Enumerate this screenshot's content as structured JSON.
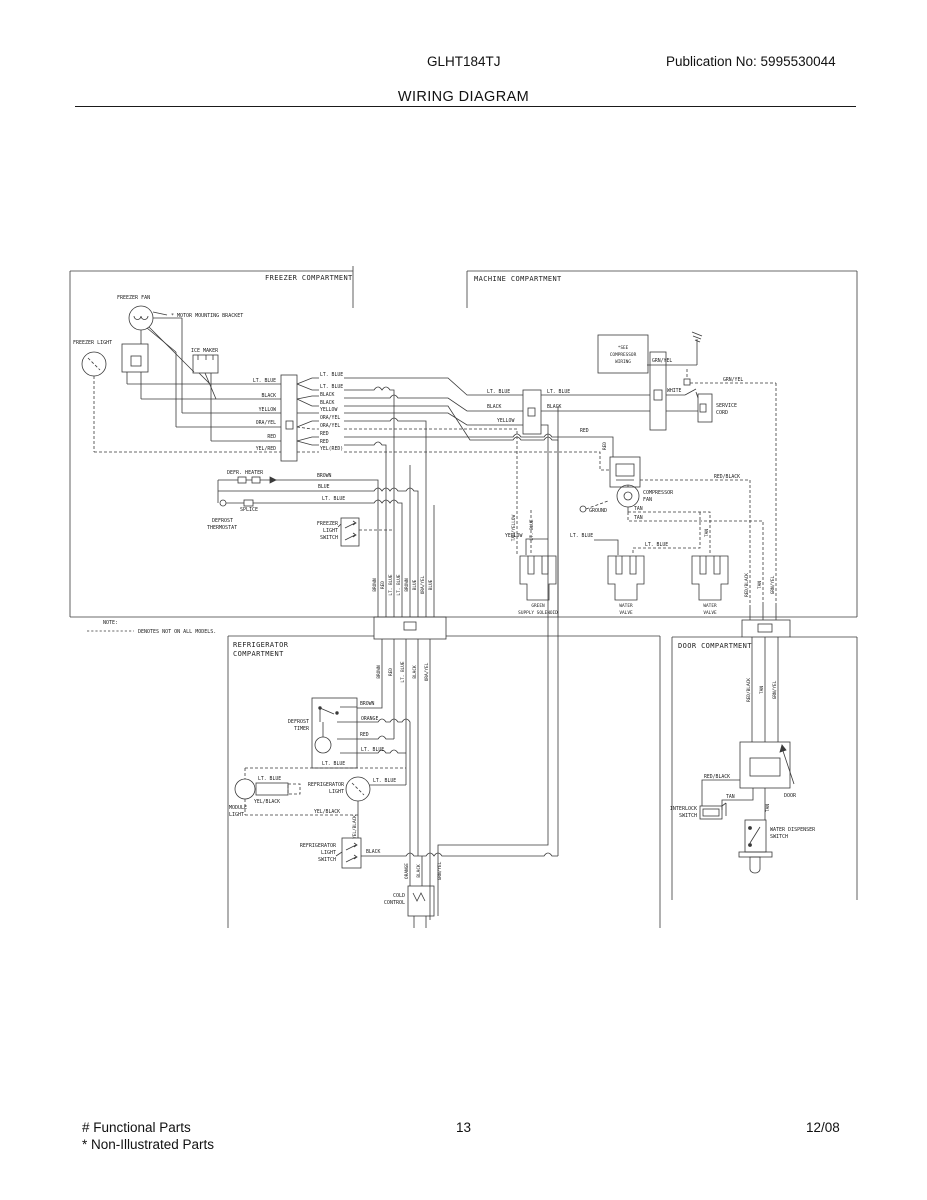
{
  "header": {
    "model": "GLHT184TJ",
    "publication": "Publication No:  5995530044",
    "title": "WIRING DIAGRAM"
  },
  "footer": {
    "functional_parts": "# Functional Parts",
    "non_illustrated_parts": "* Non-Illustrated Parts",
    "page_number": "13",
    "date": "12/08"
  },
  "note": {
    "heading": "NOTE:",
    "text": "DENOTES NOT ON ALL MODELS."
  },
  "compartments": {
    "freezer": "FREEZER COMPARTMENT",
    "machine": "MACHINE COMPARTMENT",
    "refrigerator_line1": "REFRIGERATOR",
    "refrigerator_line2": "COMPARTMENT",
    "door": "DOOR COMPARTMENT"
  },
  "components": {
    "freezer_fan": "FREEZER FAN",
    "motor_mounting_bracket": "* MOTOR MOUNTING BRACKET",
    "freezer_light": "FREEZER LIGHT",
    "ice_maker": "ICE MAKER",
    "defr_heater": "DEFR. HEATER",
    "splice": "SPLICE",
    "defrost_thermostat_line1": "DEFROST",
    "defrost_thermostat_line2": "THERMOSTAT",
    "freezer_light_switch_line1": "FREEZER",
    "freezer_light_switch_line2": "LIGHT",
    "freezer_light_switch_line3": "SWITCH",
    "see_compressor_line1": "*SEE",
    "see_compressor_line2": "COMPRESSOR",
    "see_compressor_line3": "WIRING",
    "service_cord_line1": "SERVICE",
    "service_cord_line2": "CORD",
    "compressor_fan_line1": "COMPRESSOR",
    "compressor_fan_line2": "FAN",
    "ground": "GROUND",
    "supply_solenoid_line1": "GREEN",
    "supply_solenoid_line2": "SUPPLY SOLENOID",
    "water_valve_line1": "WATER",
    "water_valve_line2": "VALVE",
    "defrost_timer_line1": "DEFROST",
    "defrost_timer_line2": "TIMER",
    "module_light_line1": "MODULE",
    "module_light_line2": "LIGHT",
    "refrigerator_light_line1": "REFRIGERATOR",
    "refrigerator_light_line2": "LIGHT",
    "refrigerator_light_switch_line1": "REFRIGERATOR",
    "refrigerator_light_switch_line2": "LIGHT",
    "refrigerator_light_switch_line3": "SWITCH",
    "cold_control_line1": "COLD",
    "cold_control_line2": "CONTROL",
    "interlock_switch_line1": "INTERLOCK",
    "interlock_switch_line2": "SWITCH",
    "water_dispenser_switch_line1": "WATER DISPENSER",
    "water_dispenser_switch_line2": "SWITCH",
    "door": "DOOR"
  },
  "wires": {
    "lt_blue": "LT. BLUE",
    "black": "BLACK",
    "yellow": "YELLOW",
    "ora_yel": "ORA/YEL",
    "red": "RED",
    "yel_red": "YEL/RED",
    "yel_red_paren": "YEL(RED)",
    "brown": "BROWN",
    "blue": "BLUE",
    "orange": "ORANGE",
    "tan": "TAN",
    "tan_yellow": "TAN/YELLOW",
    "grn_yel": "GRN/YEL",
    "red_black": "RED/BLACK",
    "white": "WHITE",
    "yel_black": "YEL/BLACK"
  }
}
